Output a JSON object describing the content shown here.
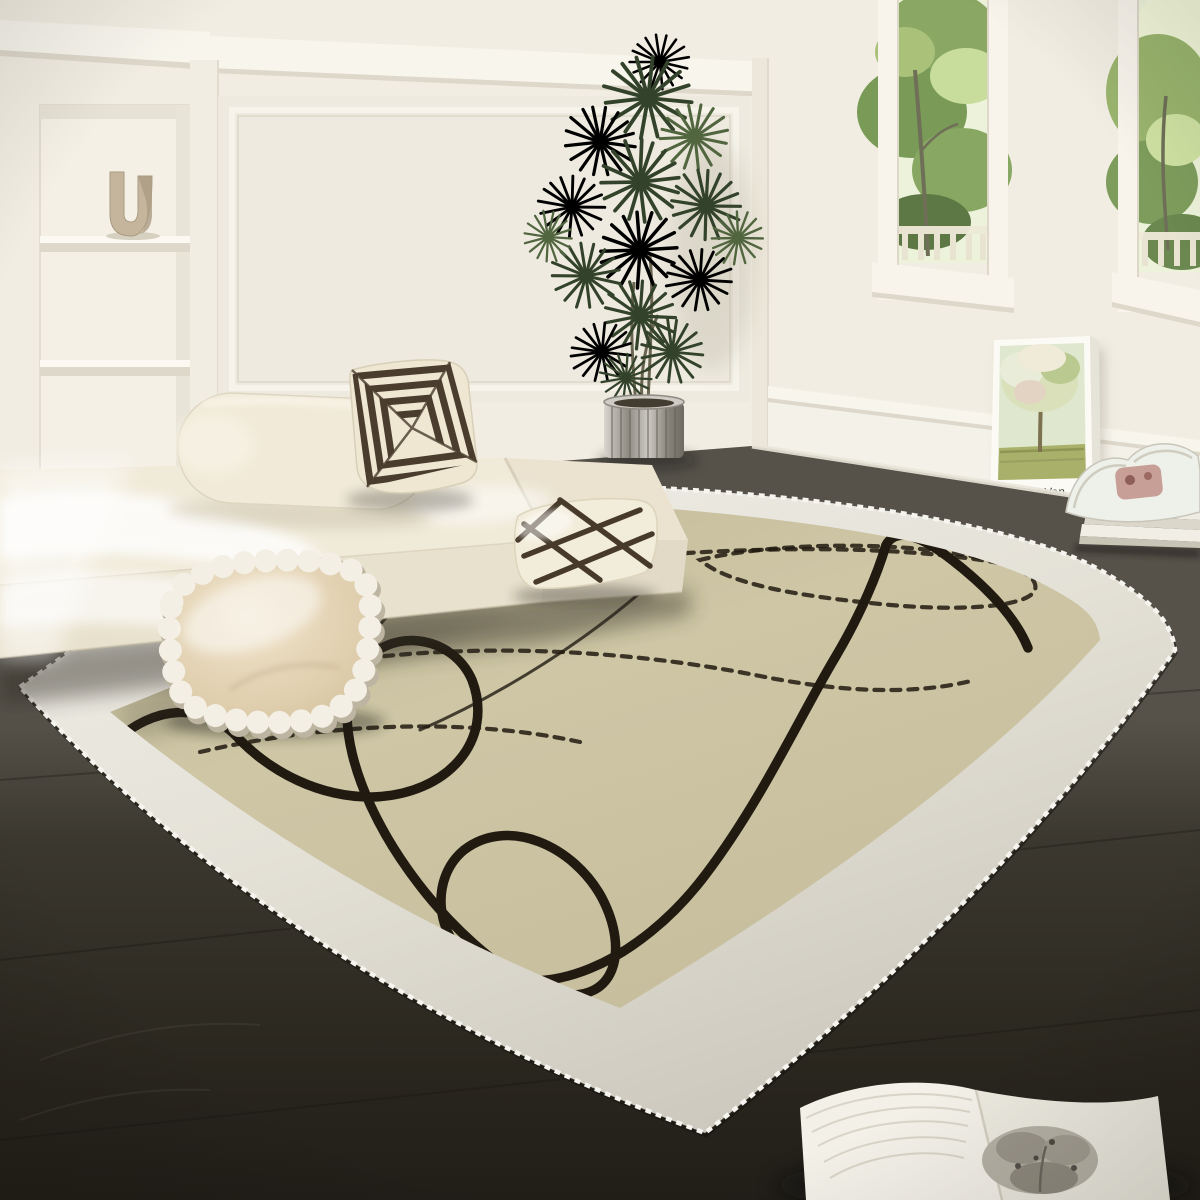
{
  "scene": {
    "type": "interior photograph",
    "room": "living room",
    "subject": "cream bordered area rug with abstract black doodle lines",
    "lighting": "bright daylight with sun patches on sofa",
    "objects": [
      "low cream platform sofa",
      "geometric striped throw pillow",
      "lattice-pattern cushion",
      "pompom-trimmed satin pillow",
      "recessed white wall shelves",
      "U-shaped beige vase",
      "tall potted green plant in silver ribbed pot",
      "two tall windows with garden view and railing",
      "leaning art print of an orchard painting",
      "stack of magazines with rolled magazine",
      "open book on dark wood floor",
      "dark wood plank floor",
      "area rug: cream border, khaki field, black line art, serged edge"
    ]
  },
  "poster": {
    "title_text": "Vincent Van",
    "artwork": "orchard tree painting print"
  },
  "rug": {
    "border": "cream white",
    "field": "khaki beige",
    "pattern": "continuous thick black doodle loops with dashed stitch lines",
    "edge": "white zigzag serged binding"
  },
  "colors": {
    "wall": "#f1ede2",
    "wall_panel": "#eeeadf",
    "trim_white": "#f8f5ed",
    "trim_shadow": "#ddd8ca",
    "niche": "#f4f0e6",
    "vase_beige": "#c4b59c",
    "window_frame": "#f8f4ec",
    "window_sky": "#edf2da",
    "foliage_outside": "#8aa763",
    "foliage_dark": "#5d7845",
    "poster_canvas": "#fbfaf4",
    "poster_text": "#3c3c35",
    "floor_light": "#56524a",
    "floor_dark": "#23211b",
    "rug_border": "#e6e3da",
    "rug_border_shadow": "#b9b5aa",
    "rug_field": "#cbc2a1",
    "rug_field_light": "#d7d0b0",
    "rug_line": "#211a11",
    "sofa_cream": "#f0ead9",
    "sofa_front": "#e8e1cd",
    "sofa_backrest": "#f1ead9",
    "pillow_geometric_dark": "#4a3d2e",
    "pillow_geometric_base": "#efe7d2",
    "pillow_lattice_base": "#f2ecda",
    "pillow_lattice_line": "#473a2b",
    "pillow_pompom_center": "#e3d2b2",
    "pillow_pompom_trim": "#f3efe4",
    "plant_green": "#41523in4",
    "plant_green_dark": "#33422a",
    "plant_green_light": "#51653f",
    "pot_silver": "#b0aaa2",
    "book_page": "#f3f0e8"
  }
}
